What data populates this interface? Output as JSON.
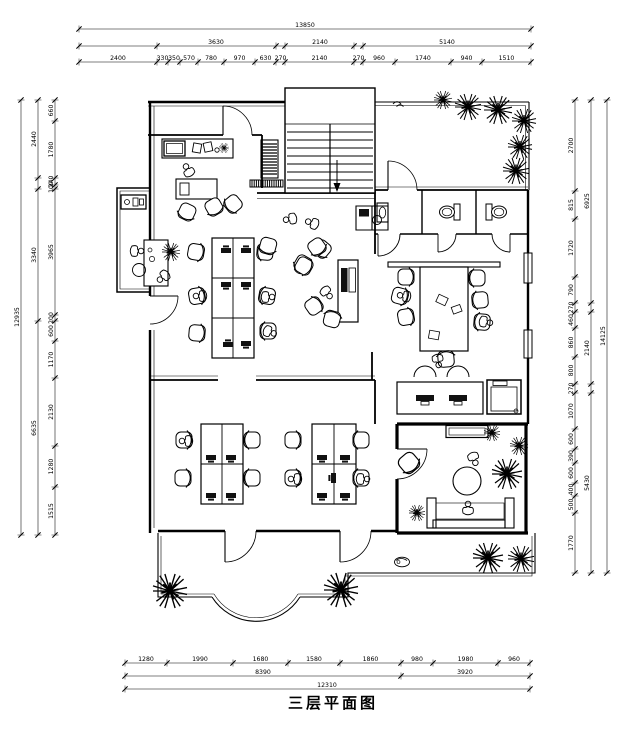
{
  "title": "三层平面图",
  "dimensions": {
    "top": {
      "overall": "13850",
      "row2": [
        "3630",
        "2140",
        "5140"
      ],
      "row3": [
        "2400",
        "330",
        "350",
        "570",
        "780",
        "970",
        "630",
        "270",
        "2140",
        "270",
        "960",
        "1740",
        "940",
        "1510"
      ]
    },
    "bottom": {
      "row1": [
        "1280",
        "1990",
        "1680",
        "1580",
        "1860",
        "980",
        "1980",
        "960"
      ],
      "row2": [
        "8390",
        "3920"
      ],
      "overall": "12310"
    },
    "left": {
      "inner": [
        "660",
        "1780",
        "240",
        "100",
        "3965",
        "200",
        "600",
        "1170",
        "2130",
        "1280",
        "1515"
      ],
      "middle": [
        "2440",
        "3340",
        "6635"
      ],
      "overall": "12935"
    },
    "right": {
      "inner": [
        "2700",
        "815",
        "1720",
        "790",
        "270",
        "460",
        "860",
        "800",
        "270",
        "1070",
        "600",
        "390",
        "600",
        "400",
        "500",
        "1770"
      ],
      "middle": [
        "6925",
        "2140",
        "5430"
      ],
      "overall": "14125"
    }
  }
}
